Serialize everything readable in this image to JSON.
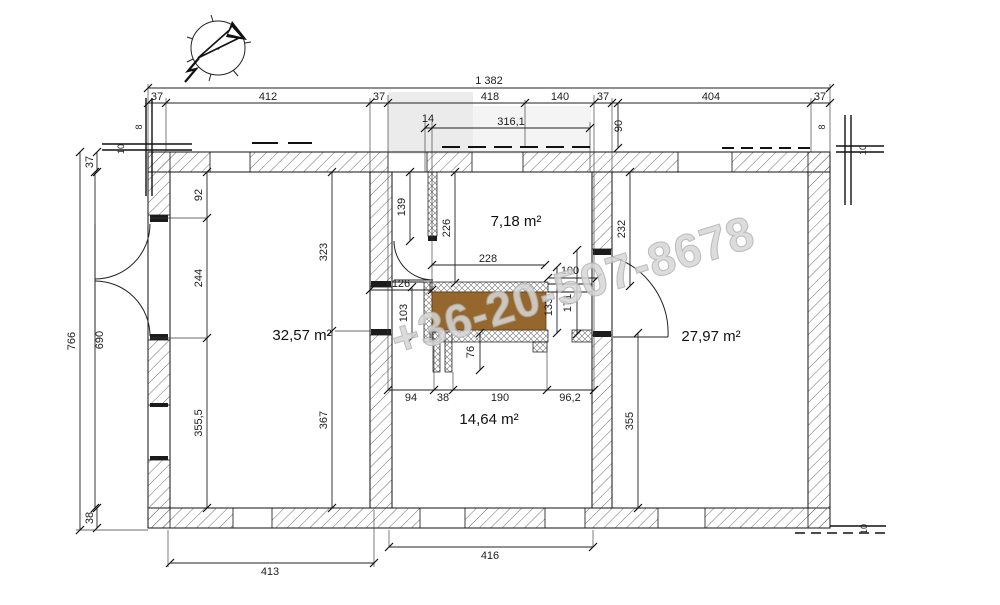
{
  "watermark": {
    "text": "+36-20-507-8678",
    "color": "#d7d7d7"
  },
  "rooms": {
    "left": {
      "label": "32,57 m²"
    },
    "top": {
      "label": "7,18 m²"
    },
    "right": {
      "label": "27,97 m²"
    },
    "bottom": {
      "label": "14,64 m²"
    }
  },
  "furniture": {
    "counter_color": "#96672C"
  },
  "dims": {
    "tw": "1 382",
    "a37": "37",
    "a412": "412",
    "b37": "37",
    "a418": "418",
    "a140": "140",
    "c37": "37",
    "a404": "404",
    "d37": "37",
    "a14": "14",
    "a316": "316,1",
    "a90": "90",
    "a766": "766",
    "l37": "37",
    "l38": "38",
    "a690": "690",
    "a92": "92",
    "a244": "244",
    "a3555": "355,5",
    "a323": "323",
    "a367": "367",
    "a139": "139",
    "a226": "226",
    "a232": "232",
    "a126": "126",
    "a103": "103",
    "a228": "228",
    "a100": "100",
    "a171": "171",
    "a133": "133",
    "a76": "76",
    "a94": "94",
    "b38": "38",
    "a190": "190",
    "a962": "96,2",
    "a355": "355",
    "a416": "416",
    "a413": "413",
    "m10": "10",
    "m8": "8"
  }
}
